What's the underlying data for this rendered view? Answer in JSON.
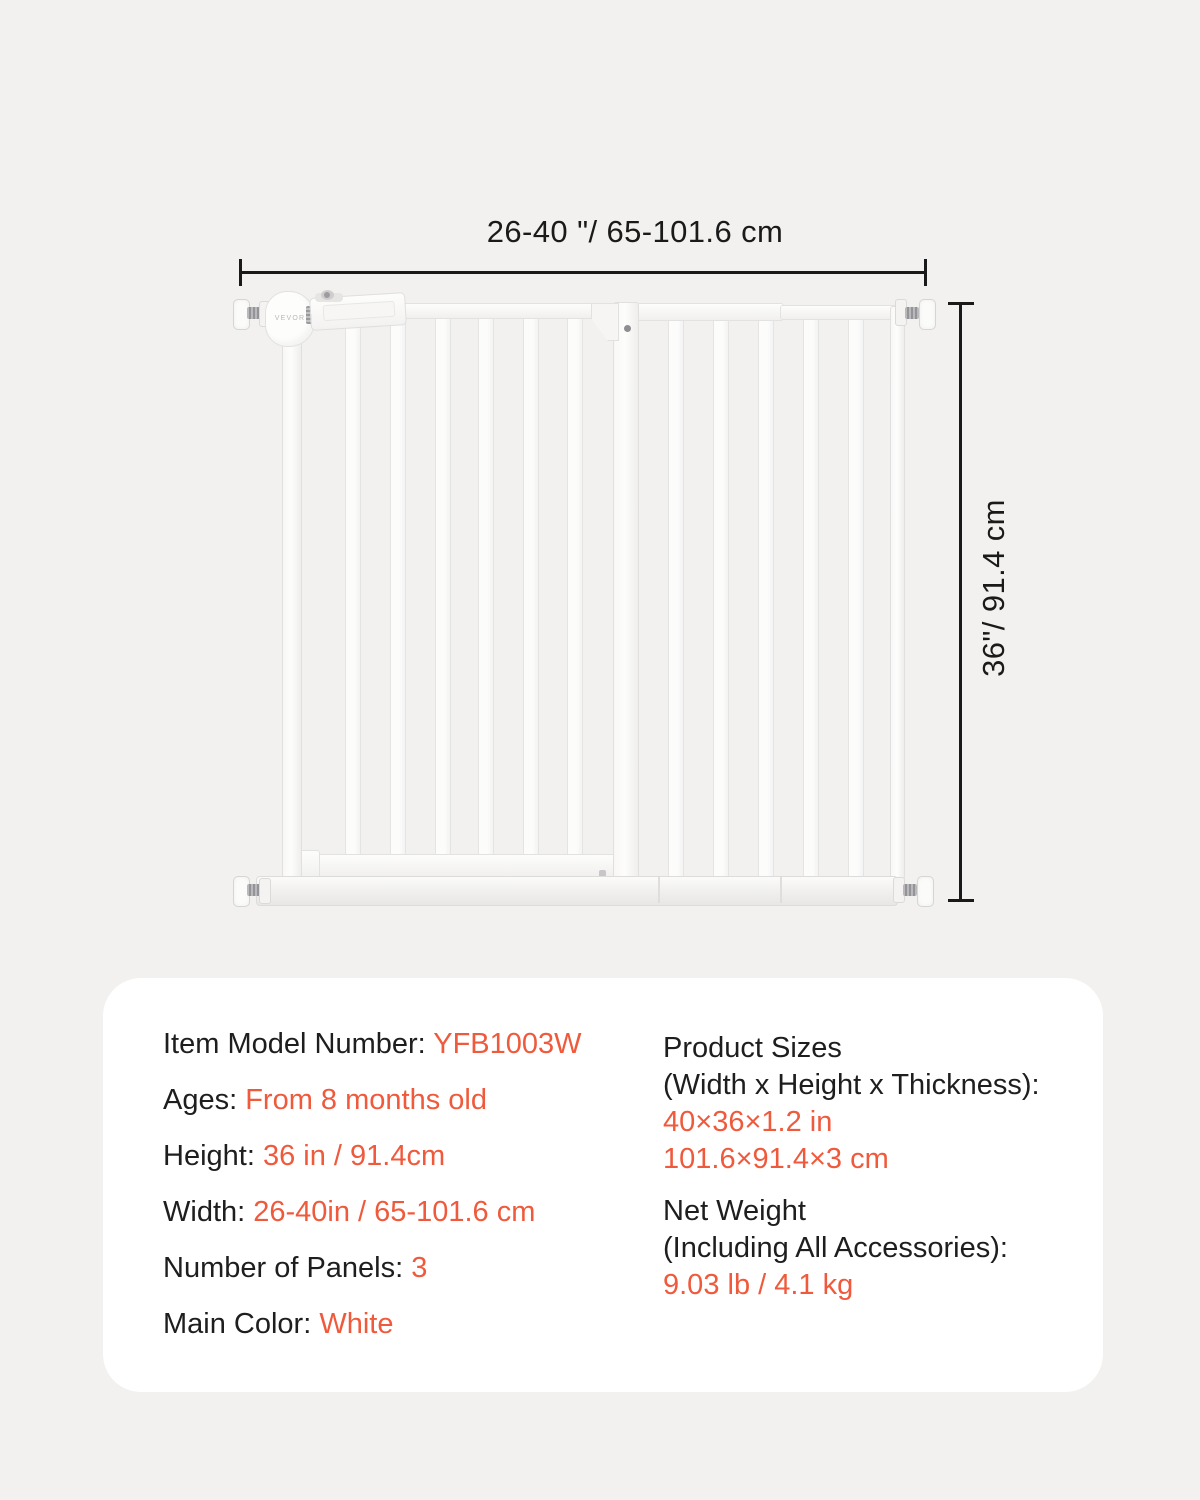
{
  "colors": {
    "background": "#f2f1ef",
    "panel": "#ffffff",
    "text": "#1e1e1e",
    "accent_orange": "#f05a3c",
    "dimension_line": "#1a1a1a",
    "gate_white": "#fdfdfc"
  },
  "diagram": {
    "width_dimension": "26-40 \"/ 65-101.6 cm",
    "height_dimension": "36\"/ 91.4 cm",
    "brand": "VEVOR"
  },
  "specs": {
    "left": [
      {
        "label": "Item Model Number: ",
        "value": "YFB1003W"
      },
      {
        "label": "Ages: ",
        "value": "From 8 months old"
      },
      {
        "label": "Height: ",
        "value": "36 in / 91.4cm"
      },
      {
        "label": "Width: ",
        "value": "26-40in / 65-101.6 cm"
      },
      {
        "label": "Number of Panels: ",
        "value": "3"
      },
      {
        "label": "Main Color: ",
        "value": "White"
      }
    ],
    "right": [
      {
        "label_lines": [
          "Product Sizes",
          "(Width x Height x Thickness):"
        ],
        "value_lines": [
          "40×36×1.2 in",
          "101.6×91.4×3 cm"
        ]
      },
      {
        "label_lines": [
          "Net Weight",
          "(Including All Accessories):"
        ],
        "value_lines": [
          "9.03 lb / 4.1 kg"
        ]
      }
    ]
  }
}
